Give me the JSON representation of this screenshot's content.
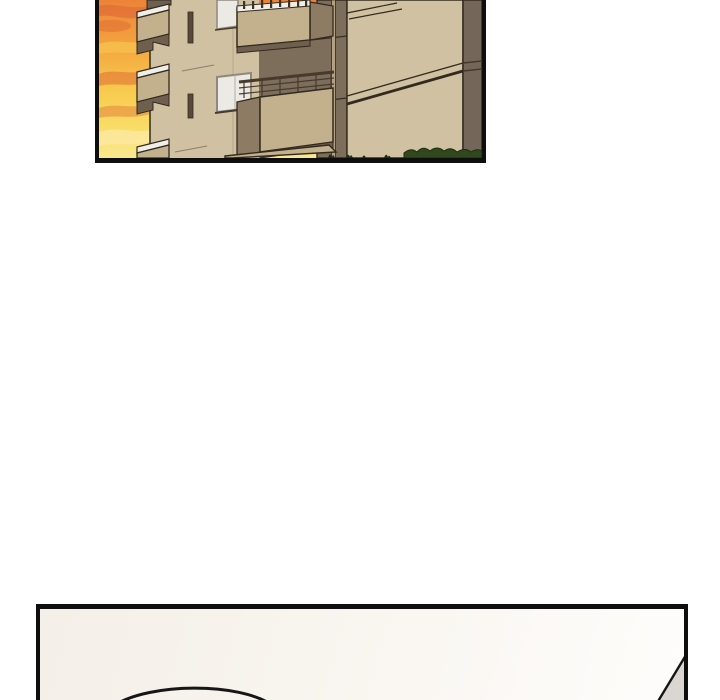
{
  "page": {
    "kind": "comic-strip",
    "description": "Vertical webtoon page with two comic panels separated by a large white gutter; no text or UI chrome visible"
  },
  "colors": {
    "page_background": "#ffffff",
    "panel_border": "#0e0e0e",
    "sky_top": "#ec8338",
    "sky_upper_mid": "#f3a33f",
    "sky_mid": "#f7c84b",
    "sky_lower": "#f9dc66",
    "sky_bottom": "#fbe88e",
    "cloud_red": "#dd6434",
    "cloud_amber": "#f6c14e",
    "cloud_pale": "#fce9a2",
    "wall_light": "#cfc1a1",
    "wall_mid": "#c3b18e",
    "wall_dark": "#8d7b64",
    "wall_darker": "#6e5f4e",
    "recess_brown": "#7d6d5b",
    "corner_brown": "#75665a",
    "window_white": "#eceae5",
    "window_frame": "#8e887e",
    "slit_dark": "#584a3a",
    "outline_brown": "#332a1e",
    "bush_green": "#31481f",
    "tuft_dark": "#202b15",
    "pipe_tan": "#b3a183",
    "closeup_bg_warm": "#f4efe8",
    "closeup_bg_white": "#fefdfb",
    "wedge_gray": "#dad7d2",
    "head_line": "#161616"
  },
  "panels": {
    "building_panel": {
      "description": "Exterior of a tan apartment building with stacked balconies, slit windows and white windows against an orange-yellow sunset sky; dark recessed wall band, brown corner wall and green shrubs at ground level",
      "position": "top, partially cut off at the top edge of the page"
    },
    "closeup_panel": {
      "description": "Mostly empty cream panel; the rounded top of a character's head enters from the bottom edge and a gray shaded wedge sits in the lower-right corner",
      "position": "bottom, cut off at the bottom edge of the page"
    }
  }
}
